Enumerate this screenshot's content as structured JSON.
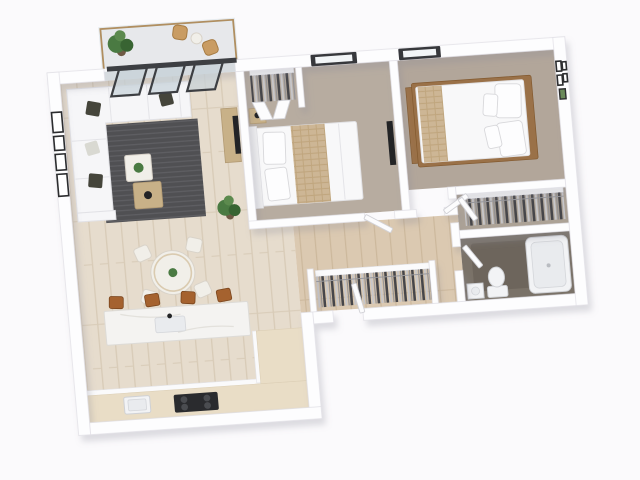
{
  "scene": {
    "title": "3D apartment floor plan render",
    "view": "isometric top-down",
    "background": "#fbfafc"
  },
  "colors": {
    "background": "#fbfafc",
    "wall": "#fdfdfe",
    "wallStroke": "#e0dfe5",
    "wallShadow": "#8a8a96",
    "woodBase": "#e6dccd",
    "woodLine": "#d8cbb7",
    "hallWood": "#dbc9b1",
    "hallWoodLine": "#ccb89c",
    "carpet1": "#b7aca0",
    "carpet2": "#b2a69a",
    "carpetCloset": "#aca296",
    "bathTile": "#7a7268",
    "bathTileDark": "#6d655c",
    "balconyFloor": "#e7e8eb",
    "rug": "#505053",
    "rugStripe": "#5e5e62",
    "sofa": "#f6f6f8",
    "pillowDark": "#45453b",
    "tableWhite": "#f1efe9",
    "tableWood": "#c8b188",
    "islandTop": "#f4f3f1",
    "stool": "#a5622f",
    "counterWood": "#e9ddc6",
    "cooktop": "#2a2b2e",
    "bedWhite": "#f8f8f9",
    "bedTan": "#cdb695",
    "bedFrame": "#9a7148",
    "clothesDark": "#46464a",
    "clothesLight": "#c7c7cb",
    "glassDoor": "#c7d3d9",
    "doorFrameDark": "#3d3f43",
    "windowFrame": "#37383c",
    "railWood": "#b08e60",
    "plant": "#4a7a42",
    "plantDark": "#386432",
    "tub": "#f2f3f5",
    "fixtureStroke": "#cfd1d5",
    "doorLeaf": "#fcfcfd"
  },
  "rooms": [
    {
      "name": "balcony",
      "floor": "light concrete",
      "items": [
        "glass railing with wood cap",
        "potted plant",
        "two rattan chairs",
        "side table",
        "open dark-framed sliding doors"
      ]
    },
    {
      "name": "living-room",
      "floor": "light wood planks",
      "items": [
        "white L-shaped sofa with dark pillows",
        "charcoal rug",
        "white coffee table with plant",
        "wood side table",
        "wall picture frames",
        "TV with wood console",
        "tall potted plant"
      ]
    },
    {
      "name": "dining-area",
      "floor": "light wood planks",
      "items": [
        "round dining table with greenery",
        "four white chairs"
      ]
    },
    {
      "name": "kitchen",
      "floor": "light wood planks",
      "items": [
        "white marble island with sink",
        "four cognac bar stools",
        "wood countertop run",
        "dark cooktop",
        "kitchen sink"
      ]
    },
    {
      "name": "bedroom-1",
      "floor": "beige carpet",
      "items": [
        "white bed with tan runner",
        "nightstand with lamp",
        "closet with hanging clothes and bifold doors",
        "dark framed window",
        "wall mirror"
      ]
    },
    {
      "name": "bedroom-2",
      "floor": "taupe carpet",
      "items": [
        "wood-framed bed with white duvet and pillows",
        "tan foot runner",
        "gallery picture frames",
        "dark framed window"
      ]
    },
    {
      "name": "walk-in-closet",
      "floor": "carpet",
      "items": [
        "hanging clothes rail",
        "white shelf"
      ]
    },
    {
      "name": "hallway",
      "floor": "sand wood planks",
      "items": [
        "open white doors",
        "built-in wardrobe with hanging clothes"
      ]
    },
    {
      "name": "bathroom",
      "floor": "dark grey tile",
      "items": [
        "bathtub",
        "toilet",
        "vanity basin"
      ]
    }
  ]
}
